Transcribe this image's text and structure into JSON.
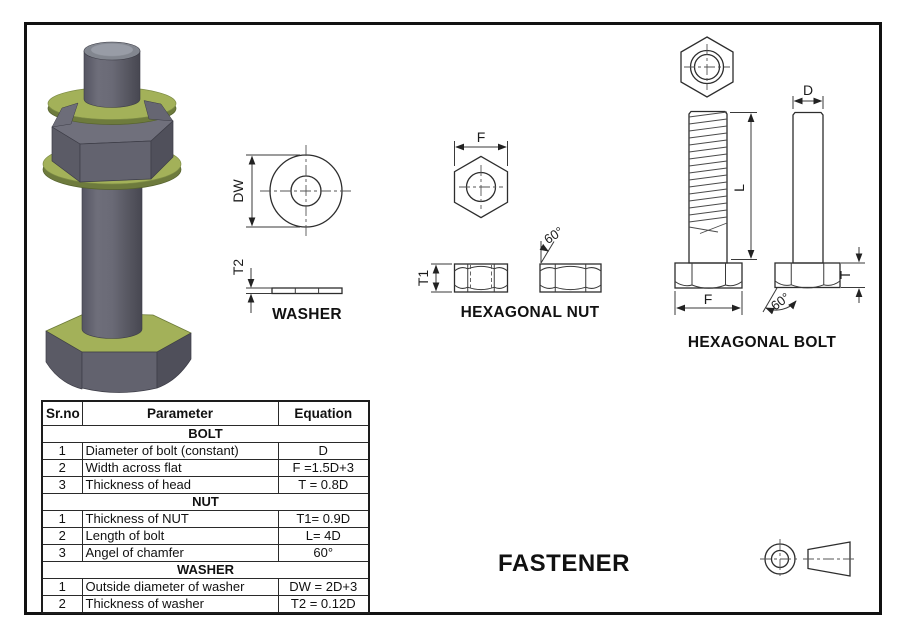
{
  "labels": {
    "washer_view": "WASHER",
    "nut_view": "HEXAGONAL NUT",
    "bolt_view": "HEXAGONAL BOLT",
    "sheet_title": "FASTENER"
  },
  "dims": {
    "washer_outer_diameter": "DW",
    "washer_thickness": "T2",
    "nut_width_across_flats": "F",
    "nut_thickness": "T1",
    "nut_chamfer_angle": "60°",
    "bolt_diameter": "D",
    "bolt_length": "L",
    "bolt_head_thickness": "T",
    "bolt_width_across_flats": "F",
    "bolt_chamfer_angle": "60°"
  },
  "table": {
    "headers": [
      "Sr.no",
      "Parameter",
      "Equation"
    ],
    "sections": [
      {
        "name": "BOLT",
        "rows": [
          [
            "1",
            "Diameter of bolt (constant)",
            "D"
          ],
          [
            "2",
            "Width across flat",
            "F =1.5D+3"
          ],
          [
            "3",
            "Thickness of head",
            "T = 0.8D"
          ]
        ]
      },
      {
        "name": "NUT",
        "rows": [
          [
            "1",
            "Thickness of NUT",
            "T1= 0.9D"
          ],
          [
            "2",
            "Length of bolt",
            "L= 4D"
          ],
          [
            "3",
            "Angel of chamfer",
            "60°"
          ]
        ]
      },
      {
        "name": "WASHER",
        "rows": [
          [
            "1",
            "Outside diameter of washer",
            "DW = 2D+3"
          ],
          [
            "2",
            "Thickness of washer",
            "T2 = 0.12D"
          ]
        ]
      }
    ]
  },
  "colors": {
    "metal_gray": "#63636f",
    "washer_green": "#a3b159",
    "line": "#2d2d2d"
  }
}
